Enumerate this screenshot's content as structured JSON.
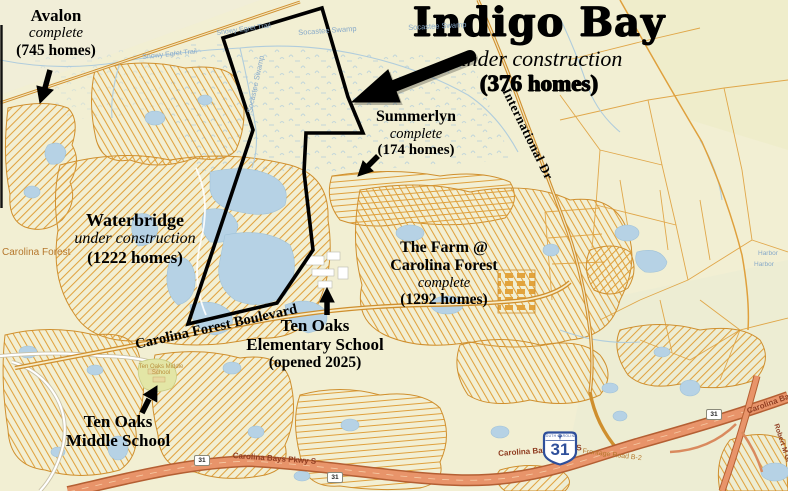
{
  "title_block": {
    "title": "Indigo Bay",
    "status": "under construction",
    "homes": "(376 homes)"
  },
  "developments": {
    "avalon": {
      "name": "Avalon",
      "status": "complete",
      "homes": "(745 homes)"
    },
    "waterbridge": {
      "name": "Waterbridge",
      "status": "under construction",
      "homes": "(1222 homes)"
    },
    "summerlyn": {
      "name": "Summerlyn",
      "status": "complete",
      "homes": "(174 homes)"
    },
    "the_farm": {
      "name1": "The Farm @",
      "name2": "Carolina Forest",
      "status": "complete",
      "homes": "(1292 homes)"
    }
  },
  "schools": {
    "elementary": {
      "line1": "Ten Oaks",
      "line2": "Elementary School",
      "line3": "(opened 2025)"
    },
    "middle": {
      "line1": "Ten Oaks",
      "line2": "Middle School"
    }
  },
  "roads": {
    "carolina_forest_blvd": "Carolina Forest Boulevard",
    "international_dr": "International Dr",
    "carolina_bays_pkwy": "Carolina Bays Pkwy S",
    "carolina_bays_short": "Carolina Ba",
    "frontage_road": "Frontage Road B-2",
    "robert_m": "Robert M Gr",
    "route_marker": "31"
  },
  "places": {
    "carolina_forest": "Carolina Forest",
    "socastee_swamp": "Socastee Swamp",
    "egret_trail": "Snowy Egret Trail",
    "harbor": "Harbor",
    "middle_school_site": "Ten Oaks Middle School"
  },
  "shield": {
    "state": "SOUTH CAROLINA",
    "number": "31"
  },
  "colors": {
    "background": "#f2efd3",
    "subdivision_orange": "#e0a23e",
    "water_blue": "#b6d2e5",
    "highway_fill": "#e8946a",
    "highway_casing": "#b45f33",
    "parcel_outline": "#000000",
    "shield_blue": "#2e4f9b"
  }
}
